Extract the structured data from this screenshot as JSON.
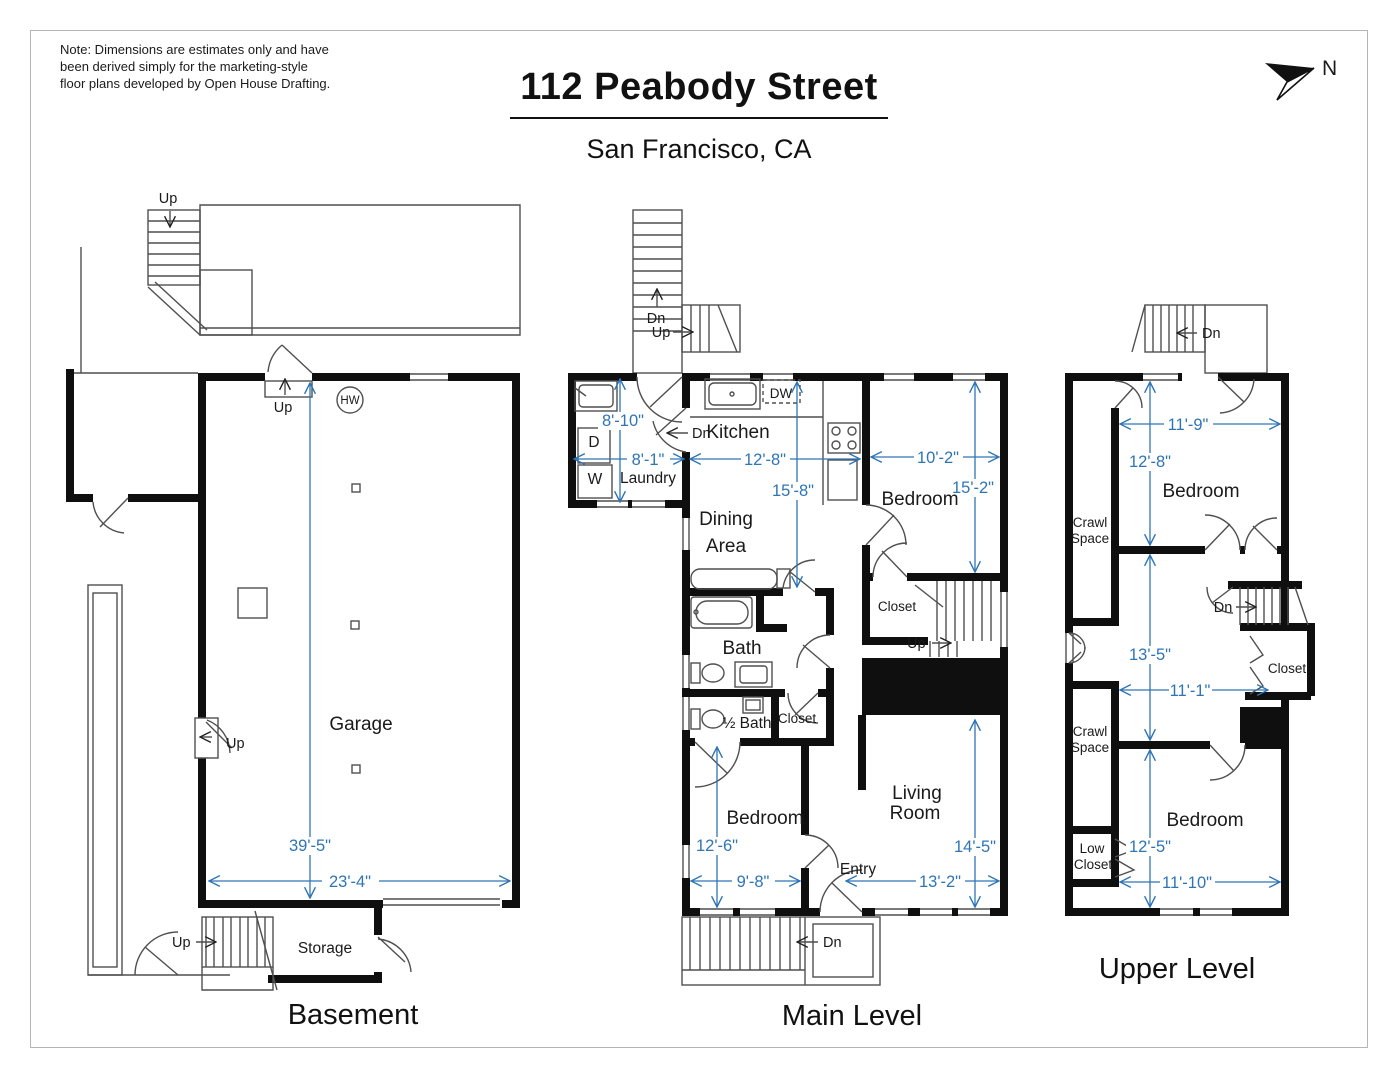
{
  "note": {
    "lines": [
      "Note: Dimensions are estimates only and have",
      "been derived simply for the marketing-style",
      "floor plans developed by Open House Drafting."
    ]
  },
  "header": {
    "title": "112 Peabody Street",
    "subtitle": "San Francisco, CA"
  },
  "compass": {
    "label": "N"
  },
  "colors": {
    "dimension": "#2e75b6",
    "wall": "#0f0f0f",
    "line": "#4f4f4f"
  },
  "levels": {
    "basement": {
      "title": "Basement",
      "rooms": {
        "garage": "Garage",
        "storage": "Storage"
      },
      "dims": {
        "depth": "39'-5\"",
        "width": "23'-4\""
      },
      "labels": {
        "hw": "HW",
        "up_deck": "Up",
        "up_entry": "Up",
        "up_side": "Up",
        "up_storage": "Up"
      }
    },
    "main": {
      "title": "Main Level",
      "rooms": {
        "laundry": "Laundry",
        "kitchen": "Kitchen",
        "dining_line1": "Dining",
        "dining_line2": "Area",
        "bath": "Bath",
        "half_bath": "½ Bath",
        "closet_half_bath": "Closet",
        "closet_stairs": "Closet",
        "bedroom_top": "Bedroom",
        "bedroom_bottom": "Bedroom",
        "living_line1": "Living",
        "living_line2": "Room",
        "entry": "Entry"
      },
      "appliances": {
        "dishwasher": "DW",
        "dryer": "D",
        "washer": "W"
      },
      "dims": {
        "laundry_depth": "8'-10\"",
        "laundry_width": "8'-1\"",
        "kitchen_width": "12'-8\"",
        "bedroom_top_width": "10'-2\"",
        "dining_depth": "15'-8\"",
        "bedroom_top_depth": "15'-2\"",
        "bedroom_bottom_depth": "12'-6\"",
        "bedroom_bottom_width": "9'-8\"",
        "living_width": "13'-2\"",
        "living_depth": "14'-5\""
      },
      "labels": {
        "stairs_dn": "Dn",
        "stairs_up": "Up",
        "door_dn": "Dn",
        "stairs_up_interior": "Up",
        "porch_dn": "Dn"
      }
    },
    "upper": {
      "title": "Upper Level",
      "rooms": {
        "bedroom_top": "Bedroom",
        "bedroom_bottom": "Bedroom",
        "crawl_top_line1": "Crawl",
        "crawl_top_line2": "Space",
        "crawl_bottom_line1": "Crawl",
        "crawl_bottom_line2": "Space",
        "closet": "Closet",
        "low_closet_line1": "Low",
        "low_closet_line2": "Closet"
      },
      "dims": {
        "bedroom_top_width": "11'-9\"",
        "bedroom_top_depth": "12'-8\"",
        "hall_depth": "13'-5\"",
        "hall_width": "11'-1\"",
        "bedroom_bottom_depth": "12'-5\"",
        "bedroom_bottom_width": "11'-10\""
      },
      "labels": {
        "exterior_dn": "Dn",
        "stairs_dn": "Dn"
      }
    }
  }
}
